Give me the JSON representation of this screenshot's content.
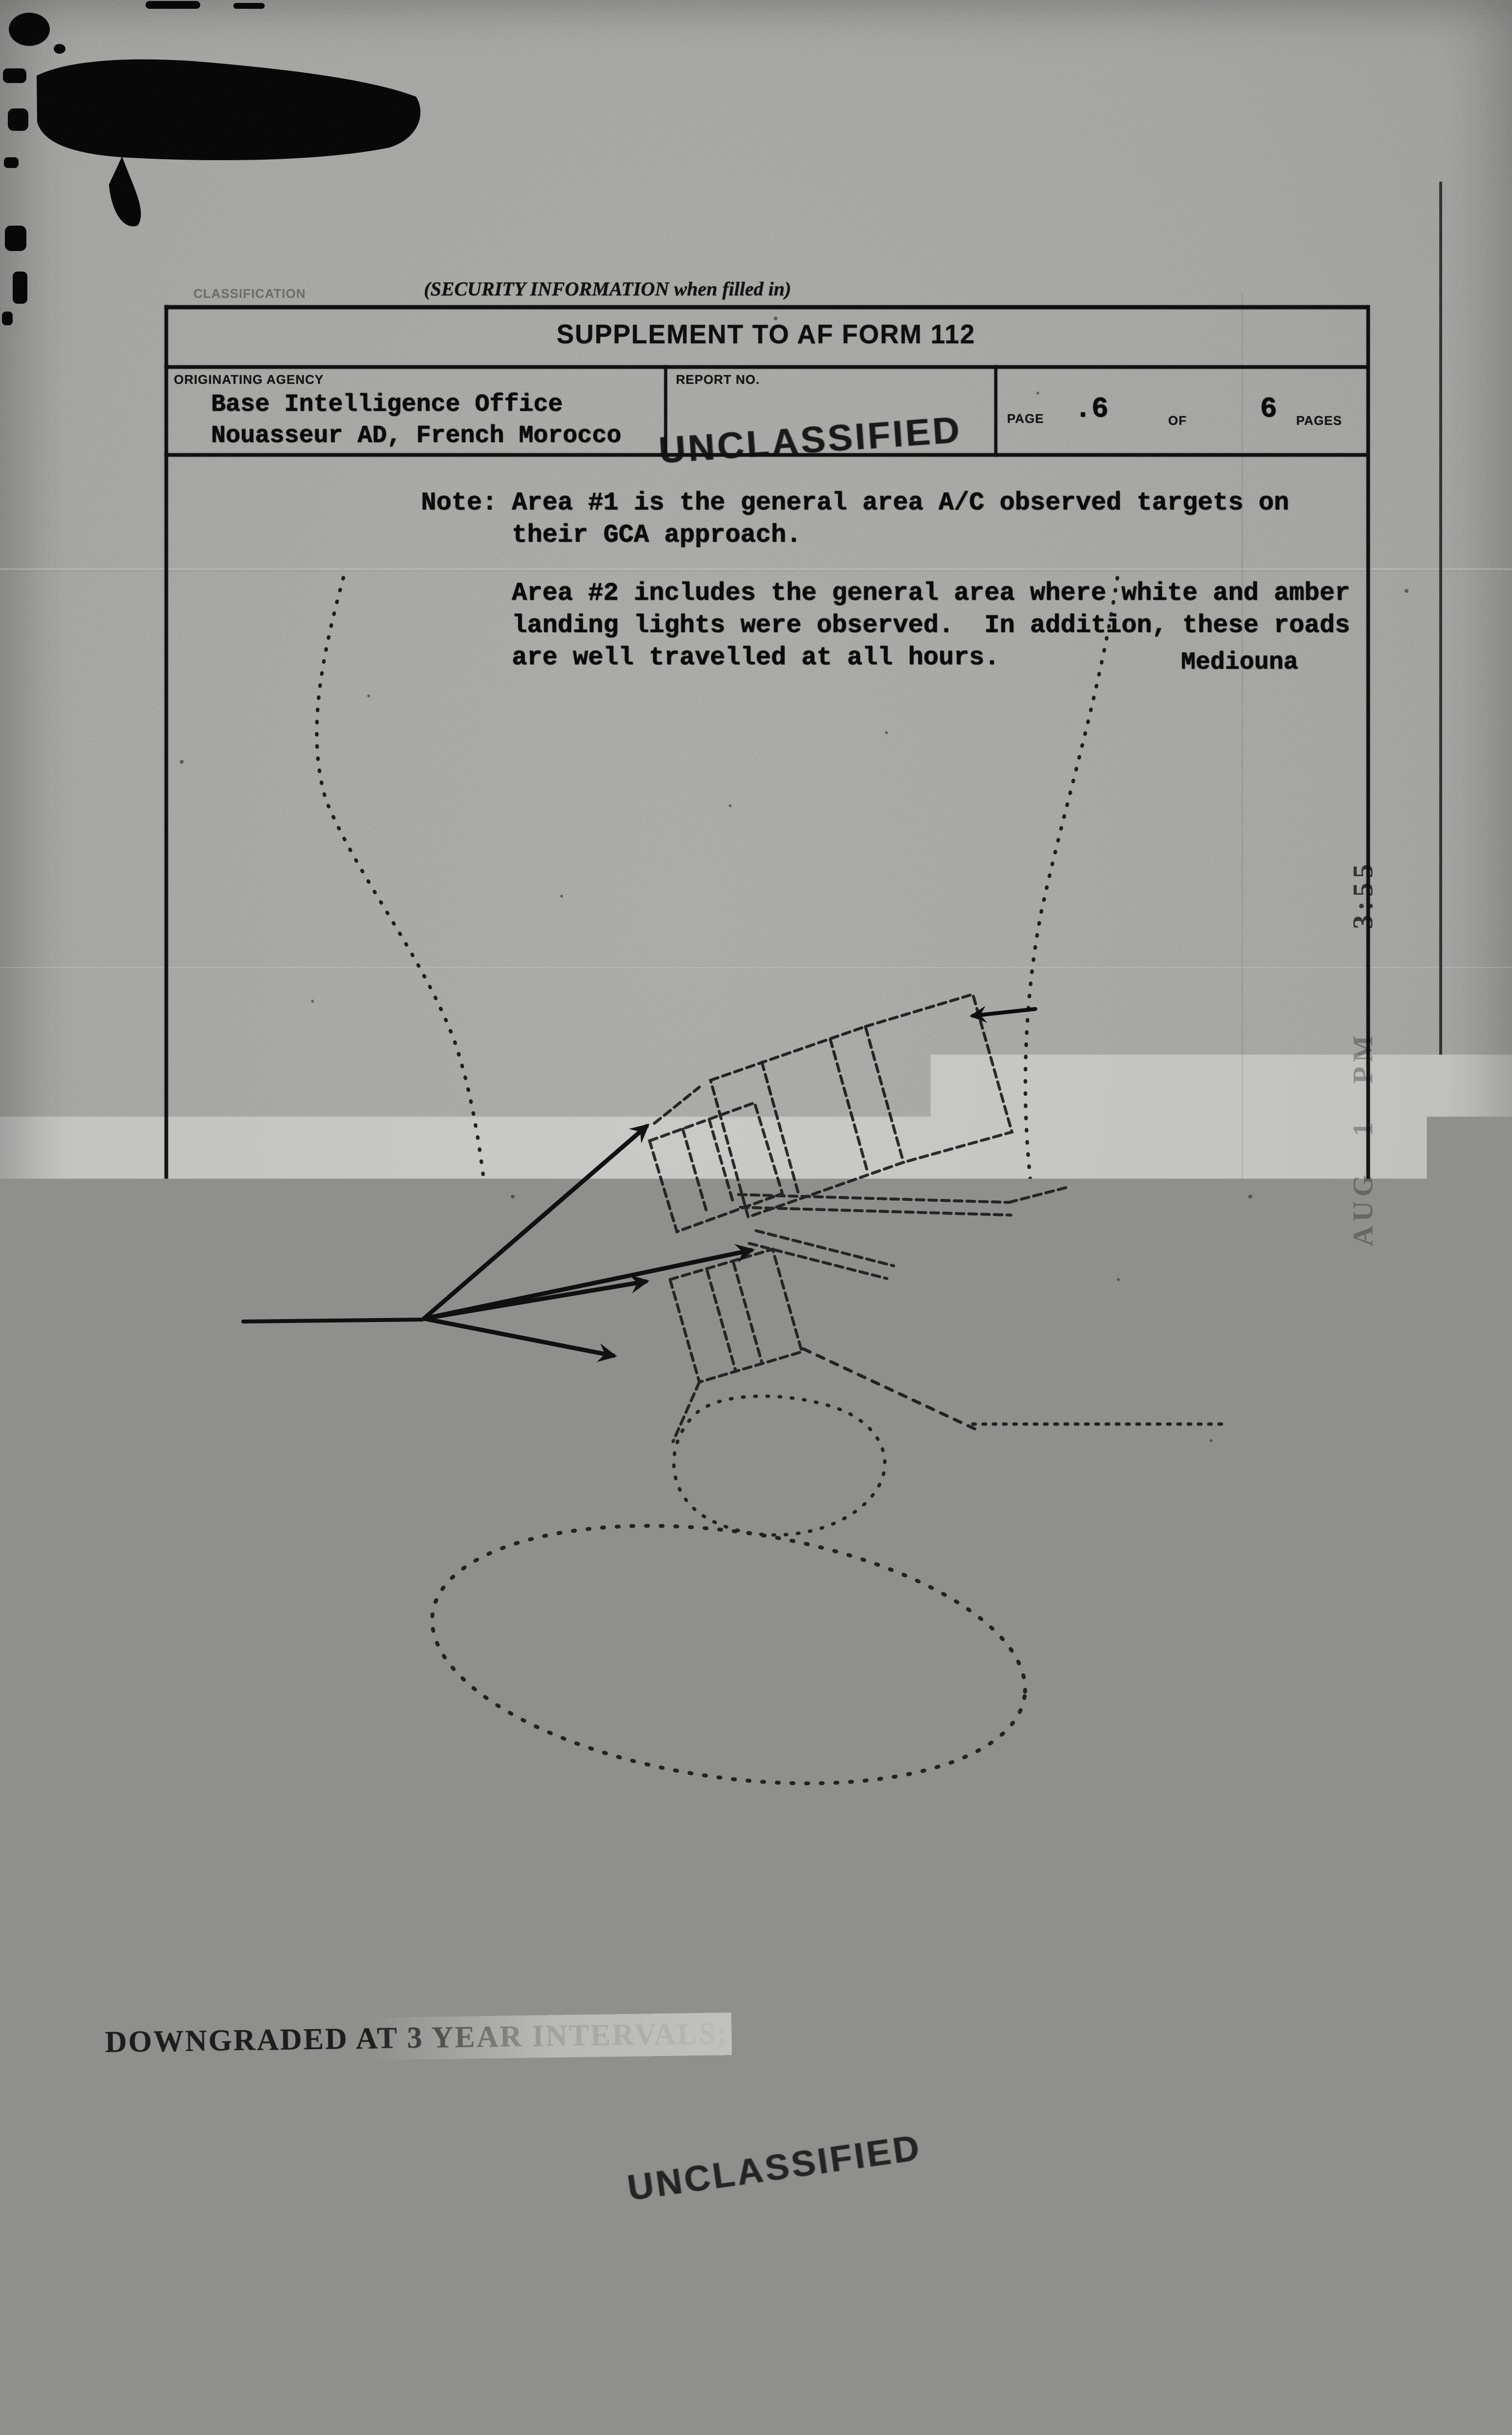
{
  "form": {
    "security_note_top": "(SECURITY INFORMATION when filled in)",
    "classification_label_top": "CLASSIFICATION",
    "title": "SUPPLEMENT TO AF FORM 112",
    "originating_agency_label": "ORIGINATING AGENCY",
    "originating_agency_line1": "Base Intelligence Office",
    "originating_agency_line2": "Nouasseur AD, French Morocco",
    "report_no_label": "REPORT NO.",
    "page_label": "PAGE",
    "page_number": ".6",
    "of_label": "OF",
    "pages_count": "6",
    "pages_label": "PAGES"
  },
  "note": {
    "label": "Note:",
    "para1_line1": "Area #1 is the general area A/C observed targets on",
    "para1_line2": "their GCA approach.",
    "para2_line1": "Area #2 includes the general area where white and amber",
    "para2_line2": "landing lights were observed.  In addition, these roads",
    "para2_line3": "are well travelled at all hours."
  },
  "map": {
    "mediouna": "Mediouna",
    "runway": "Runway",
    "runway_length": "(11,000')",
    "area1": "Area #1",
    "control_tower": "Control Tower",
    "area2": "Area #2",
    "berrechid": "Berrechid",
    "north": "N"
  },
  "stamps": {
    "unclassified": "UNCLASSIFIED",
    "for_official_use_only": "FOR OFFICIAL USE ONLY",
    "downgraded_line1": "DOWNGRADED AT 3 YEAR INTERVALS;",
    "downgraded_line2": "DECLASSIFIED AFTER 12 YEARS.",
    "downgraded_line3": "DOD DIR 5200.10",
    "received_faded": "AUG 1 PM",
    "received_dark": "3:55"
  },
  "warning": {
    "line1": "WARNING: This document contains information affecting the national defense of the United States within the meaning of the",
    "line2": "Espionage Laws, Title 18, U. S. C., Sections 793 and 794. Its transmission or the revelation of its contents in any manner to an",
    "line3": "unauthorized person is prohibited by law. It may not be reproduced in whole or in part, by other than United States Air Force",
    "line4": "Agencies, except by permission of the Director of Intelligence, USAF."
  },
  "footer": {
    "form_number": "112a",
    "replaces_line1": "REPLACES AF FORM 112-PART II, 1 JUN 48,",
    "replaces_line2": "WHICH MAY BE USED.",
    "classification_label": "CLASSIFICATION",
    "security_note_bottom": "(SECURITY INFORMATION when filled in)",
    "printing_office": "U. S. GOVERNMENT PRINTING OFFICE",
    "print_code": "16—69479"
  },
  "colors": {
    "paper": "#c3c3c1",
    "ink": "#141414",
    "stamp_ink": "#1e1e1e"
  }
}
